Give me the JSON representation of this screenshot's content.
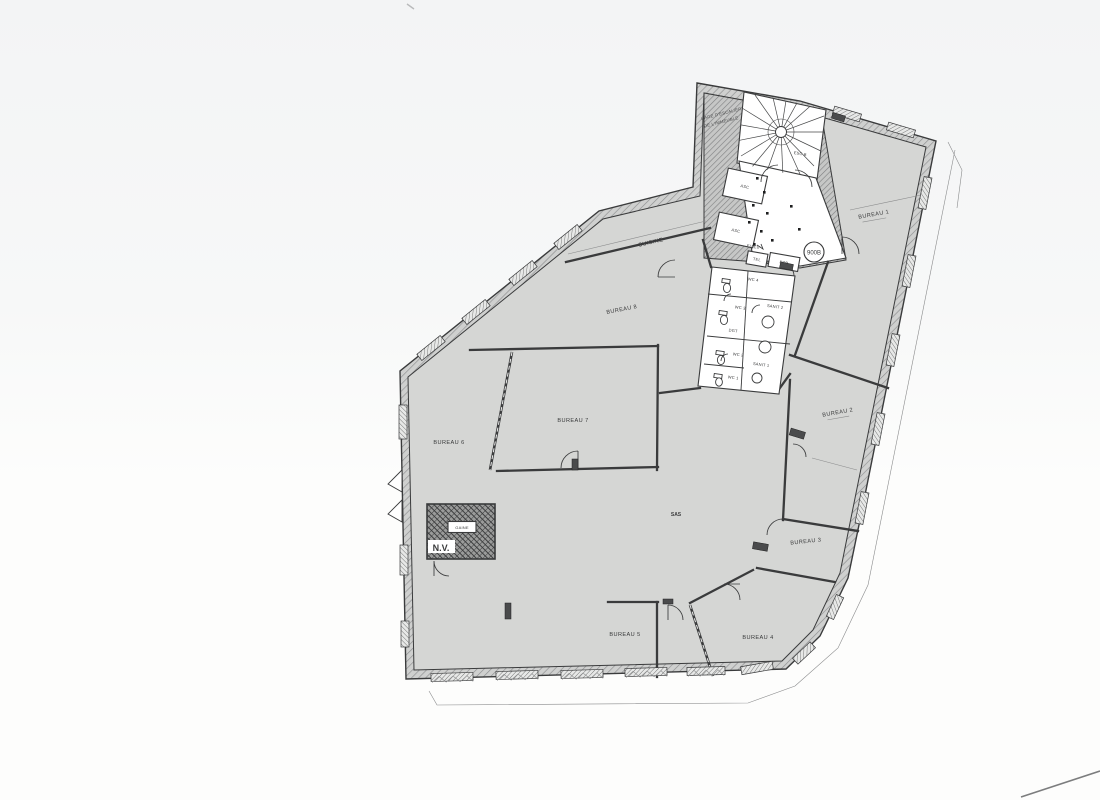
{
  "floorplan": {
    "title_hint": "Etage - plan de bureaux",
    "colors": {
      "floor": "#d5d6d4",
      "ink": "#3a3b3c",
      "hatch": "#909194",
      "paper_top": "#f3f4f5",
      "paper": "#fdfdfc",
      "shaft": "#5f6062"
    },
    "stairwell": {
      "note_line1": "CAGE D'ESCALIER",
      "note_line2": "DE L'IMMEUBLE",
      "stair_label": "ESC B",
      "elevator_a": "ASC",
      "elevator_b": "ASC",
      "tel_box": "TEL",
      "ecp_box": "ECP",
      "duct_note": "EU/EV",
      "door_tag": "900B"
    },
    "rooms": {
      "kitchen": "CUISINE",
      "office_1": "BUREAU 1",
      "office_2": "BUREAU 2",
      "office_3": "BUREAU 3",
      "office_4": "BUREAU 4",
      "office_5": "BUREAU 5",
      "office_6": "BUREAU 6",
      "office_7": "BUREAU 7",
      "office_8": "BUREAU 8",
      "vestibule": "SAS"
    },
    "sanitary": {
      "wc_1": "WC 1",
      "wc_2": "WC 2",
      "wc_3": "WC 3",
      "wc_4": "WC 4",
      "sanit_1": "SANIT 1",
      "sanit_2": "SANIT 2",
      "corridor": "DGT"
    },
    "shaft": {
      "label": "GAINE",
      "vent": "N.V."
    }
  }
}
